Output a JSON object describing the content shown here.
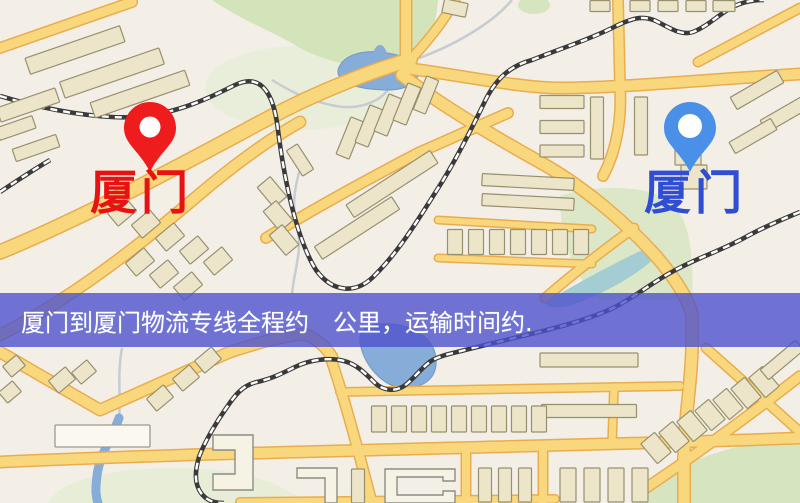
{
  "map": {
    "origin_marker": {
      "label": "厦门",
      "icon": "red-map-pin",
      "pin_color": "#ee1c1c",
      "label_color": "#e81212"
    },
    "destination_marker": {
      "label": "厦门",
      "icon": "blue-map-pin",
      "pin_color": "#4a90e8",
      "label_color": "#2f4ed4"
    },
    "banner": {
      "text": "厦门到厦门物流专线全程约　公里，运输时间约.",
      "background": "#4b4fce",
      "text_color": "#ffffff"
    },
    "palette": {
      "land": "#f3efe7",
      "road": "#f8d77d",
      "road_casing": "#e9ad4f",
      "park": "#d3e3ba",
      "water": "#86acd8",
      "building": "#ede5c9",
      "railway": "#3a3a3a",
      "banner_overlay": "#4b4fce"
    }
  }
}
